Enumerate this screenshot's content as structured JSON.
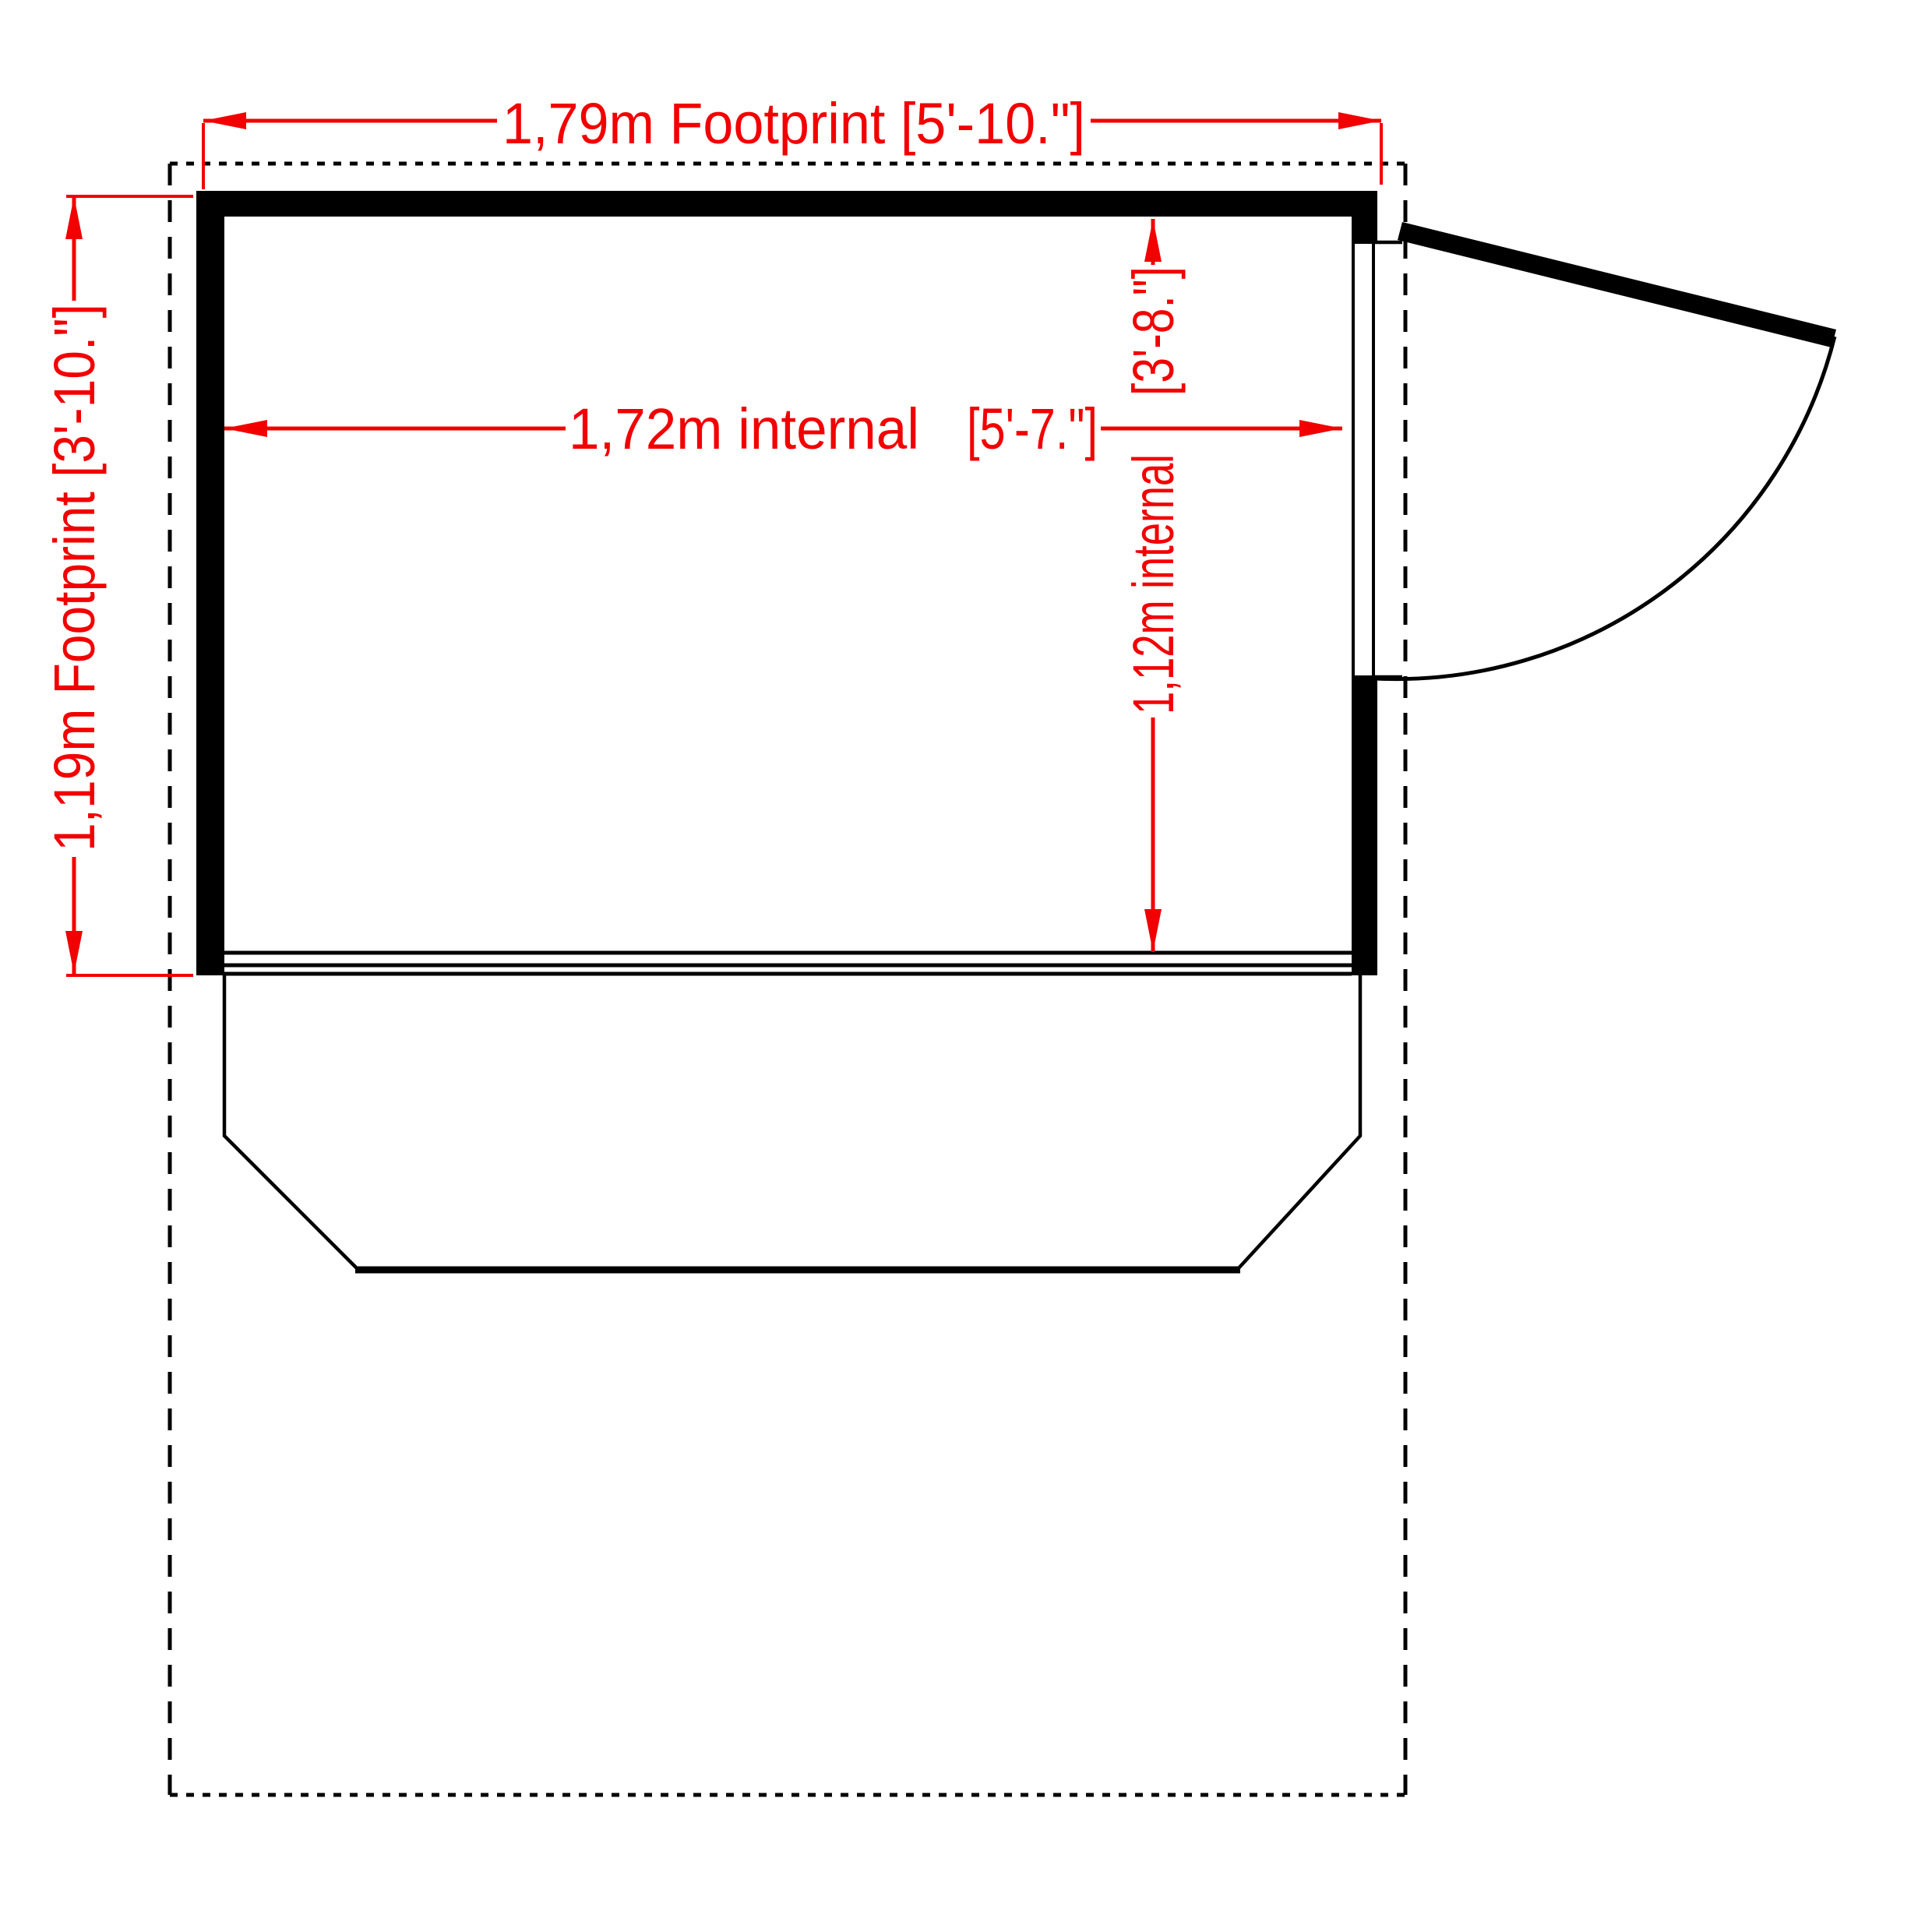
{
  "drawing": {
    "type": "floor-plan",
    "colors": {
      "dimension_red": "#f20000",
      "outline_black": "#000000",
      "background": "#ffffff"
    },
    "dimensions": {
      "footprint_width": {
        "label": "1,79m Footprint [5'-10.\"]"
      },
      "footprint_depth": {
        "label": "1,19m Footprint [3'-10.\"]"
      },
      "internal_width": {
        "metric": "1,72m internal",
        "imperial": "[5'-7.\"]"
      },
      "internal_depth": {
        "metric": "1,12m internal",
        "imperial": "[3'-8.\"]"
      }
    }
  }
}
